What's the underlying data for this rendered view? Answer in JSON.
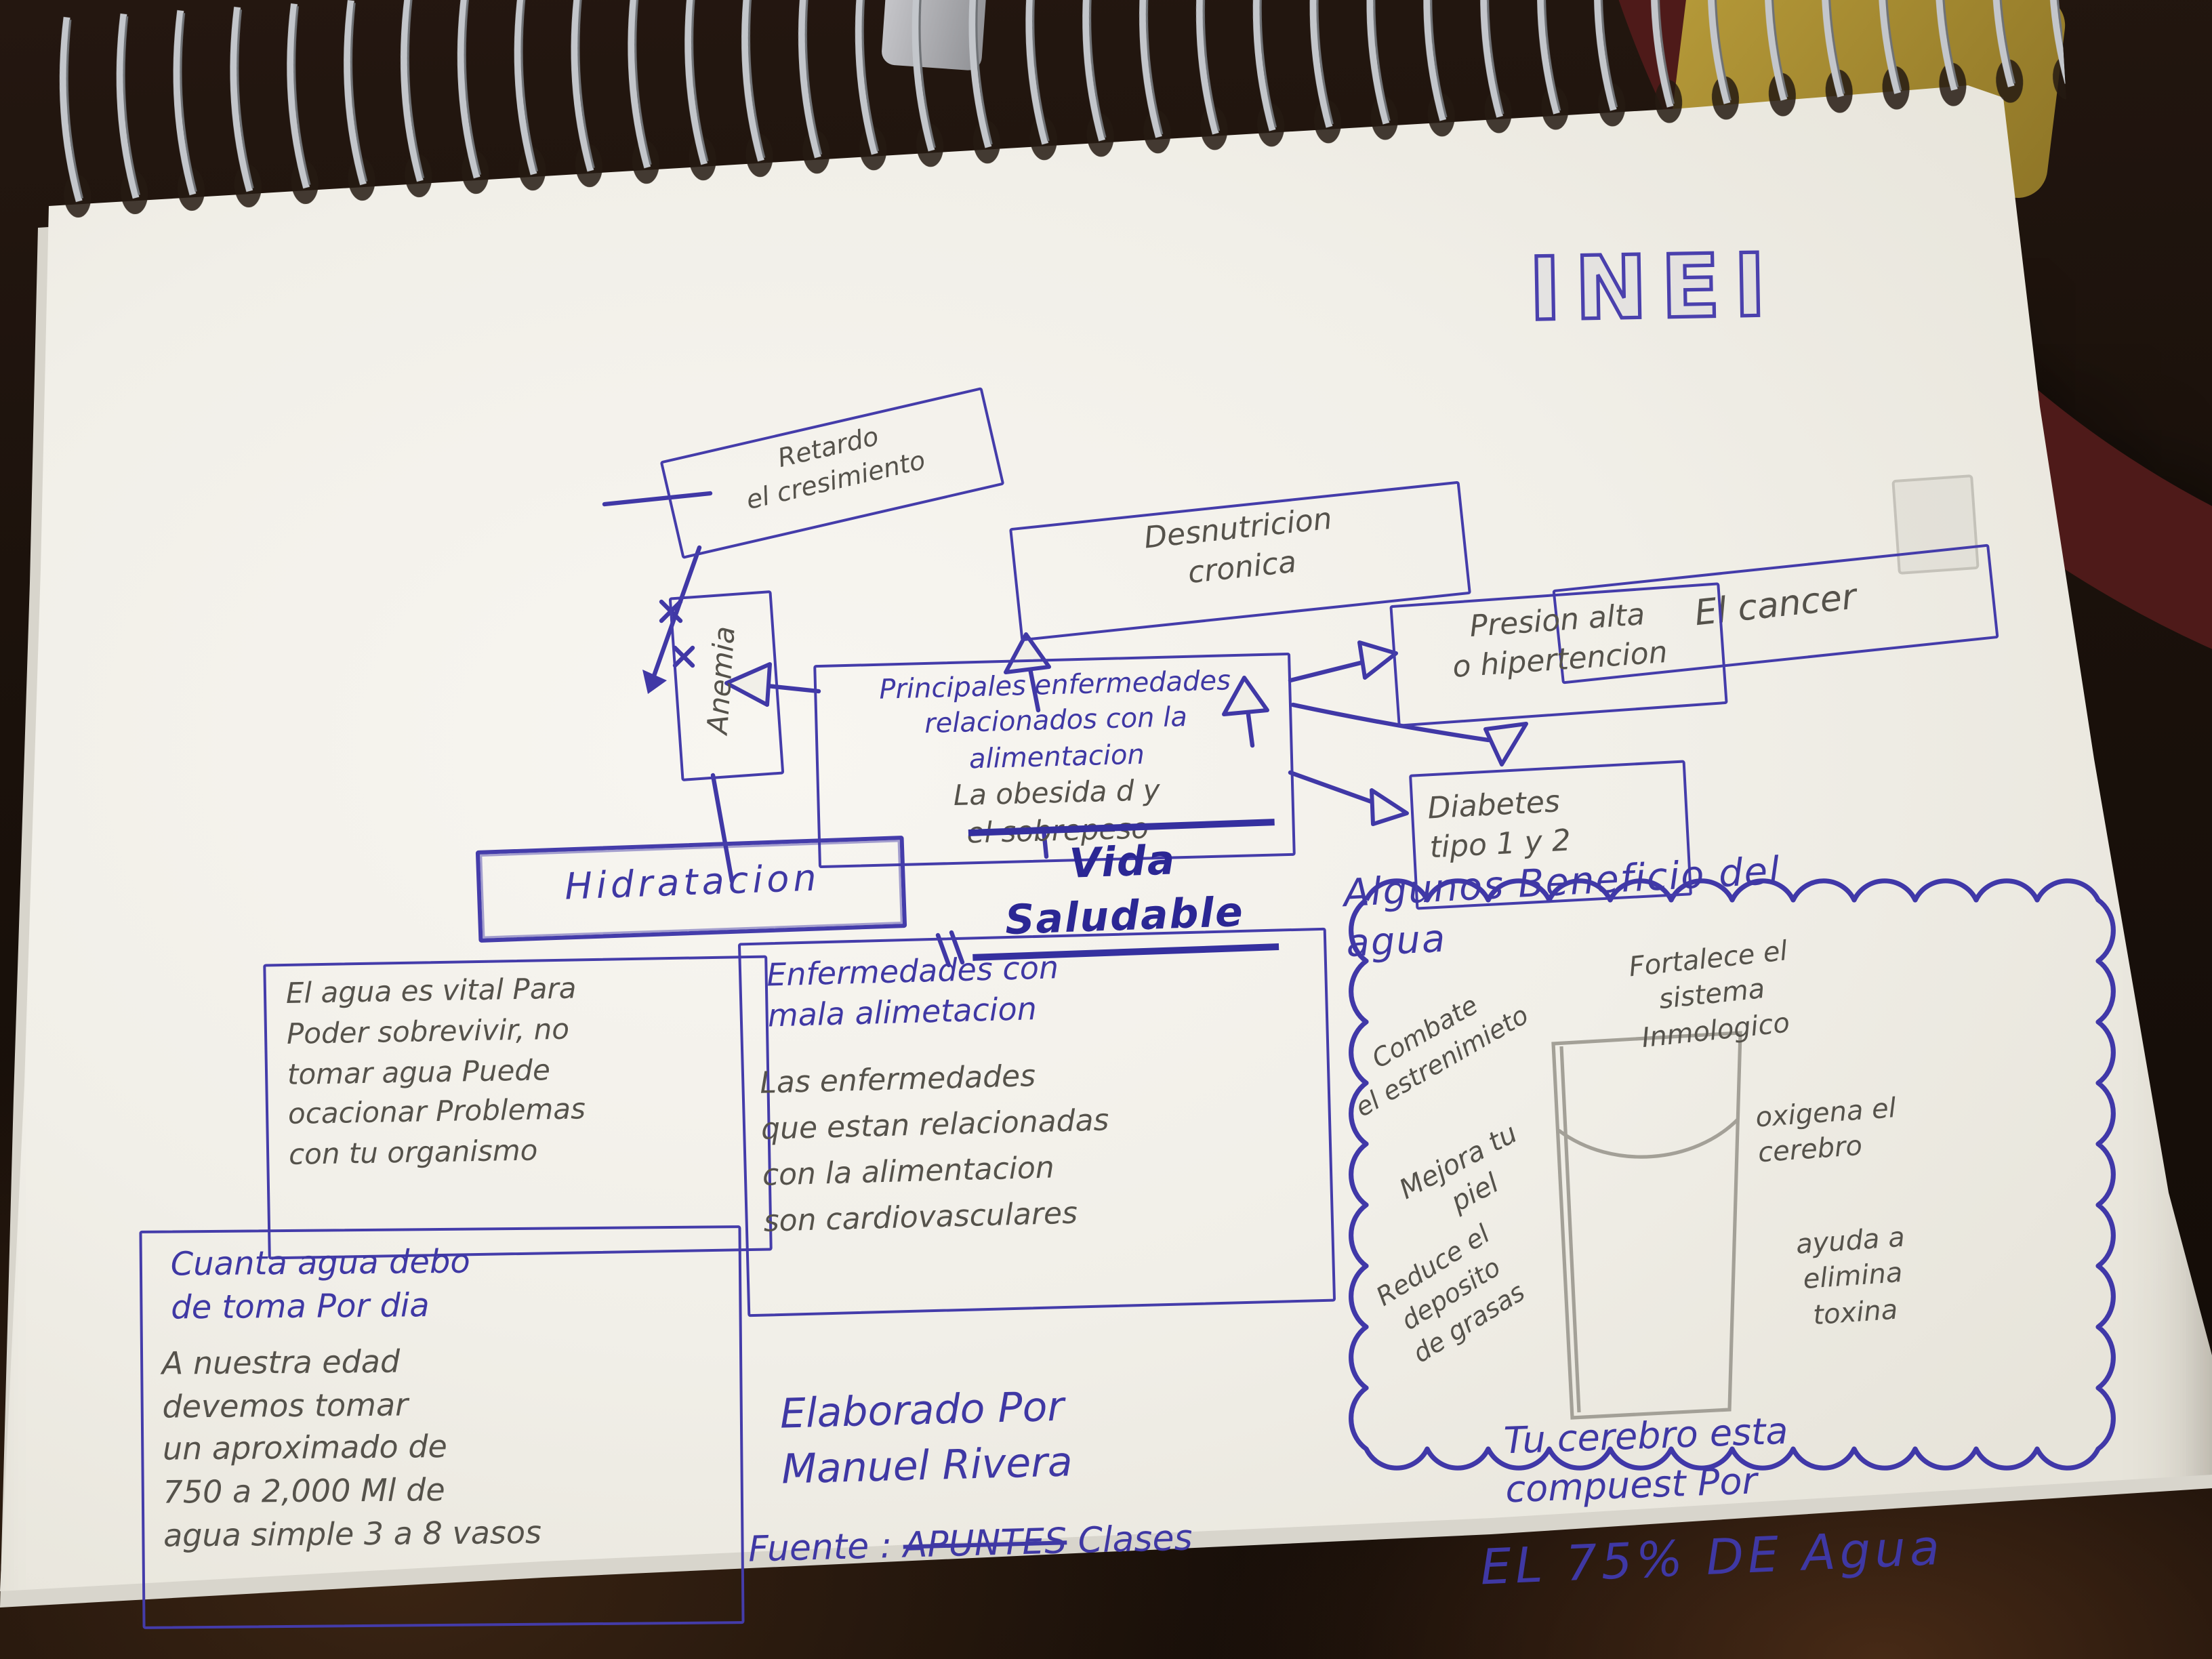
{
  "logo": "INEI",
  "nodes": {
    "retardo": "Retardo\nel cresimiento",
    "desnutricion": "Desnutricion\ncronica",
    "cancer": "El cancer",
    "anemia": "Anemia",
    "central_blue": "Principales enfermedades\nrelacionados con la\nalimentacion",
    "central_pencil": "La obesida d  y\nel sobrepeso",
    "presion": "Presion alta\no hipertencion",
    "diabetes": "Diabetes\ntipo 1 y 2",
    "hidratacion": "Hidratacion",
    "main_title": "Vida Saludable",
    "agua_vital": "El agua es vital Para\nPoder sobrevivir, no\ntomar agua Puede\nocacionar Problemas\ncon tu organismo",
    "cuanta_blue": "Cuanta agua debo\nde toma Por dia",
    "cuanta_pencil": "A nuestra edad\ndevemos tomar\nun aproximado de\n750 a 2,000 Ml de\nagua simple    3 a 8 vasos",
    "enfermedades_blue": "Enfermedades con\nmala alimetacion",
    "enfermedades_pencil": "Las enfermedades\nque estan relacionadas\ncon la alimentacion\nson cardiovasculares",
    "cloud_title": "Algunos Beneficio del\nagua"
  },
  "beneficios": [
    "Combate\nel estrenimieto",
    "Mejora tu\npiel",
    "Reduce el\ndeposito\nde grasas",
    "Fortalece el\nsistema\nInmologico",
    "oxigena el\ncerebro",
    "ayuda a\nelimina\ntoxina"
  ],
  "footer": {
    "author": "Elaborado Por\nManuel Rivera",
    "fuente_label": "Fuente :",
    "fuente_struck": "APUNTES",
    "fuente_rest": "Clases",
    "brain_l1": "Tu cerebro esta\ncompuest Por",
    "brain_l2": "EL 75% DE Agua"
  },
  "colors": {
    "pen_blue": "#3f38a4",
    "pencil_grey": "#55524b",
    "paper": "#f1efe8",
    "desk_brown": "#1a110b"
  }
}
